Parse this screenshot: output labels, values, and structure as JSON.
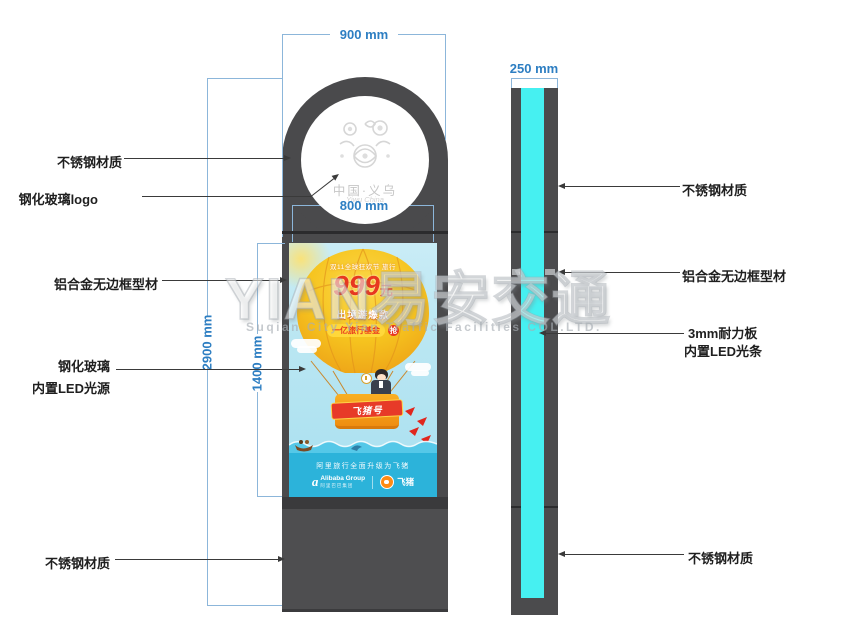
{
  "watermark": {
    "brand": "YIAN易安交通",
    "subtitle": "Suqian City Yian Traffic Facilities COL.LTD."
  },
  "dimensions": {
    "head_width": "900 mm",
    "screen_width": "800 mm",
    "total_height": "2900 mm",
    "screen_height": "1400 mm",
    "depth": "250 mm"
  },
  "front_view": {
    "labels": {
      "steel_top": "不锈钢材质",
      "glass_logo": "钢化玻璃logo",
      "alu_frame": "铝合金无边框型材",
      "glass_led_line1": "钢化玻璃",
      "glass_led_line2": "内置LED光源",
      "steel_bottom": "不锈钢材质"
    },
    "head_logo": {
      "title": "中国·义乌",
      "script": "Yiwu China"
    },
    "poster": {
      "promo_line": "双11全球狂欢节 旅行",
      "price": "999",
      "price_unit": "元",
      "tagline": "出境游爆款",
      "pill_text": "一亿旅行基金",
      "pill_badge": "抢",
      "basket_banner": "飞猪号",
      "slogan": "阿里旅行全面升级为飞猪",
      "alibaba_mark": "a",
      "alibaba_en": "Alibaba Group",
      "alibaba_cn": "阿里巴巴集团",
      "fliggy": "飞猪"
    }
  },
  "side_view": {
    "labels": {
      "steel_top": "不锈钢材质",
      "alu_frame": "铝合金无边框型材",
      "board_led_line1": "3mm耐力板",
      "board_led_line2": "内置LED光条",
      "steel_bottom": "不锈钢材质"
    }
  },
  "colors": {
    "dimension_line": "#8cb6da",
    "dimension_text": "#2d7ec2",
    "cabinet_gray": "#4a4a4c",
    "led_cyan": "#46f0f1",
    "poster_sky": "#b9e6f2",
    "poster_band": "#2cb3da",
    "balloon_yellow": "#f6c41f",
    "price_red": "#e8381f"
  }
}
